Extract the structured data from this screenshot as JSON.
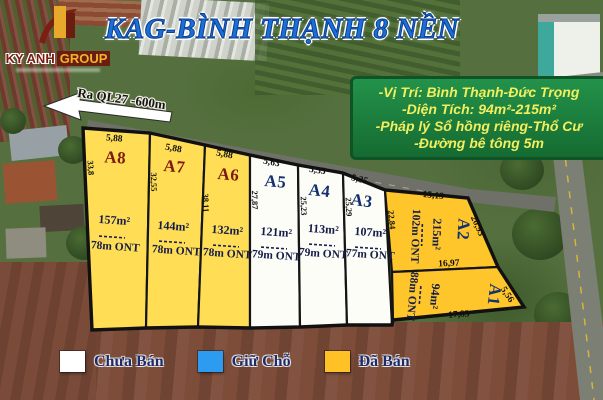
{
  "title": "KAG-BÌNH THẠNH 8 NỀN",
  "logo": {
    "primary": "KY ANH",
    "secondary": "GROUP"
  },
  "arrow": {
    "label": "Ra QL27 -600m"
  },
  "info": {
    "lines": [
      "-Vị Trí: Bình Thạnh-Đức Trọng",
      "-Diện Tích: 94m²-215m²",
      "-Pháp lý Sổ hồng riêng-Thổ Cư",
      "-Đường bê tông 5m"
    ]
  },
  "plots": [
    {
      "id": "A8",
      "area": "157m²",
      "ont": "78m ONT",
      "dim_top": "5,88",
      "dim_side": "33,8",
      "status": "Đã Bán"
    },
    {
      "id": "A7",
      "area": "144m²",
      "ont": "78m ONT",
      "dim_top": "5,88",
      "dim_side": "32,55",
      "status": "Đã Bán"
    },
    {
      "id": "A6",
      "area": "132m²",
      "ont": "78m ONT",
      "dim_top": "5,88",
      "dim_side": "38,11",
      "status": "Đã Bán"
    },
    {
      "id": "A5",
      "area": "121m²",
      "ont": "79m ONT",
      "dim_top": "5,63",
      "dim_side": "27,87",
      "status": "Chưa Bán"
    },
    {
      "id": "A4",
      "area": "113m²",
      "ont": "79m ONT",
      "dim_top": "5,35",
      "dim_side": "25,23",
      "status": "Chưa Bán"
    },
    {
      "id": "A3",
      "area": "107m²",
      "ont": "77m ONT",
      "dim_top": "5,35",
      "dim_side": "25,29",
      "status": "Chưa Bán"
    },
    {
      "id": "A2",
      "area": "215m²",
      "ont": "102m ONT",
      "dim_top": "15,19",
      "dim_side": "22,84",
      "dim_right": "20,93",
      "dim_bottom": "16,97",
      "status": "Đã Bán"
    },
    {
      "id": "A1",
      "area": "94m²",
      "ont": "88m ONT",
      "dim_right": "5,56",
      "dim_bottom": "17,83",
      "status": "Đã Bán"
    }
  ],
  "legend": {
    "items": [
      {
        "label": "Chưa Bán",
        "color": "#ffffff"
      },
      {
        "label": "Giữ Chỗ",
        "color": "#2d9cf0"
      },
      {
        "label": "Đã Bán",
        "color": "#ffc125"
      }
    ]
  },
  "colors": {
    "plot_sold_light": "#ffde55",
    "plot_sold_dark": "#ffc62b",
    "plot_available": "#fdfdf8",
    "info_box_green": "#1e8040",
    "title_blue": "#1a6fd8",
    "plot_label_red": "#7e1b10",
    "plot_label_navy": "#14306f"
  }
}
